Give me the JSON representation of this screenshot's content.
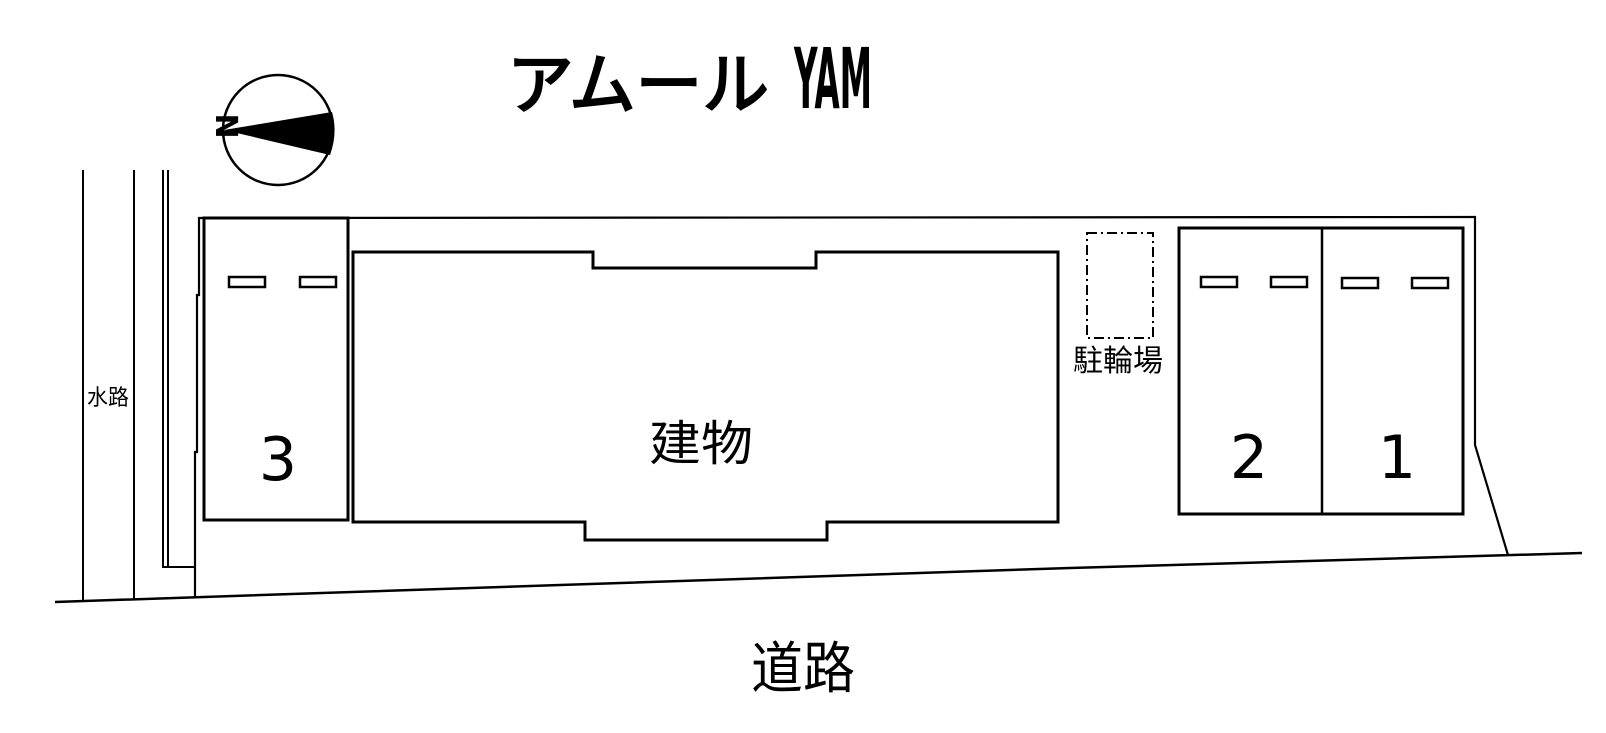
{
  "page": {
    "background": "#ffffff",
    "ink": "#000000"
  },
  "title": {
    "jp": "アムール",
    "en": "YAM"
  },
  "compass": {
    "label": "N",
    "needle_points": "left"
  },
  "labels": {
    "building": "建物",
    "bicycle_parking": "駐輪場",
    "road": "道路",
    "waterway": "水路"
  },
  "parking_spaces": [
    {
      "number": "3",
      "wheel_stops": 2
    },
    {
      "number": "2",
      "wheel_stops": 2
    },
    {
      "number": "1",
      "wheel_stops": 2
    }
  ]
}
